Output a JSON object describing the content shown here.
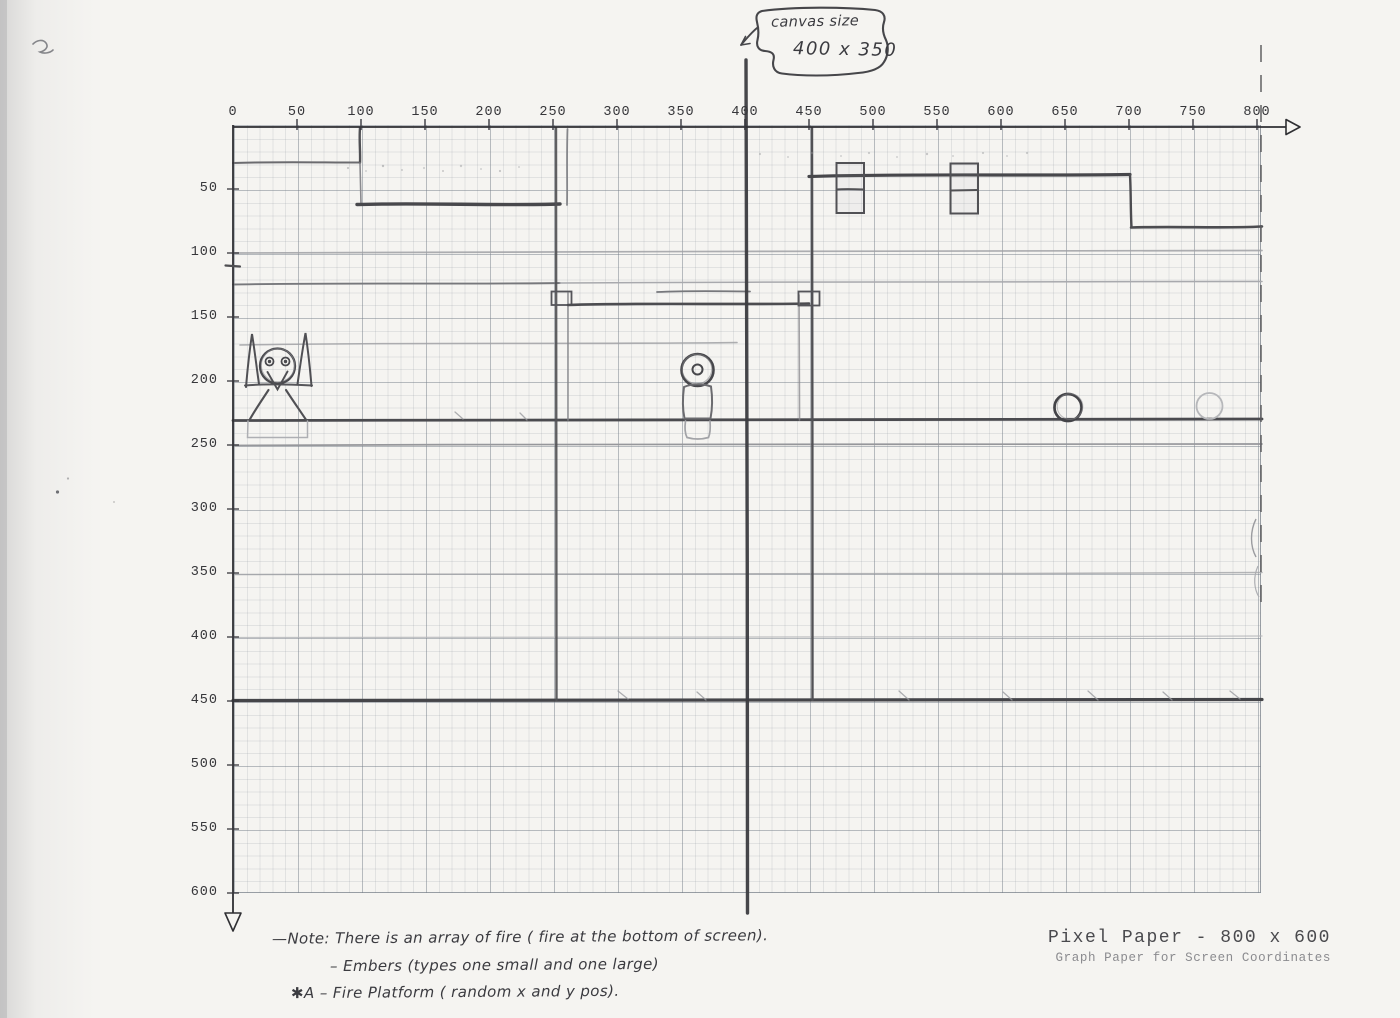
{
  "axes": {
    "x_ticks": [
      0,
      50,
      100,
      150,
      200,
      250,
      300,
      350,
      400,
      450,
      500,
      550,
      600,
      650,
      700,
      750,
      800
    ],
    "y_ticks": [
      50,
      100,
      150,
      200,
      250,
      300,
      350,
      400,
      450,
      500,
      550,
      600
    ]
  },
  "bubble": {
    "line1": "canvas size",
    "line2": "400 x 350"
  },
  "notes": {
    "line1": "—Note: There is an array of fire ( fire at the bottom of screen).",
    "line2": "– Embers (types one small and one large)",
    "line3": "✱A – Fire Platform ( random x and y pos)."
  },
  "footer": {
    "title": "Pixel Paper - 800 x 600",
    "subtitle": "Graph Paper for Screen Coordinates"
  },
  "colors": {
    "paper": "#f5f4f1",
    "pencil_dark": "#47474b",
    "pencil_medium": "#77787c",
    "pencil_faint": "#a3a4a8",
    "grid_line": "#9aa0a8"
  },
  "sketch_elements": [
    {
      "name": "canvas-size-callout",
      "text": "canvas size 400 x 350",
      "points_to_x": 400
    },
    {
      "name": "ledge-line",
      "x": [
        0,
        70
      ],
      "y": 30
    },
    {
      "name": "pit-wall",
      "x": 100,
      "y": [
        0,
        62
      ]
    },
    {
      "name": "pit-floor",
      "x": [
        100,
        255
      ],
      "y": 62
    },
    {
      "name": "column-left",
      "x": 252,
      "y": [
        0,
        450
      ]
    },
    {
      "name": "room-beam",
      "x": [
        262,
        450
      ],
      "y": 140
    },
    {
      "name": "column-right",
      "x": 452,
      "y": [
        0,
        450
      ]
    },
    {
      "name": "high-platform",
      "x": [
        450,
        700
      ],
      "y": 40
    },
    {
      "name": "platform-step",
      "x": [
        700,
        800
      ],
      "y": 80
    },
    {
      "name": "item-box",
      "x": [
        472,
        493
      ],
      "y": [
        30,
        69
      ]
    },
    {
      "name": "item-box",
      "x": [
        561,
        582
      ],
      "y": [
        30,
        69
      ]
    },
    {
      "name": "faint-line",
      "x": [
        0,
        800
      ],
      "y": 100
    },
    {
      "name": "faint-line",
      "x": [
        0,
        800
      ],
      "y": 125
    },
    {
      "name": "ground-mid",
      "x": [
        0,
        800
      ],
      "y": 230
    },
    {
      "name": "faint-line",
      "x": [
        0,
        800
      ],
      "y": 250
    },
    {
      "name": "faint-line",
      "x": [
        0,
        800
      ],
      "y": 350
    },
    {
      "name": "faint-line",
      "x": [
        0,
        800
      ],
      "y": 400
    },
    {
      "name": "ground-main",
      "x": [
        0,
        800
      ],
      "y": 450
    },
    {
      "name": "canvas-boundary",
      "x": 400,
      "y": [
        0,
        600
      ]
    },
    {
      "name": "right-boundary-dashed",
      "x": 800,
      "y": [
        0,
        380
      ]
    },
    {
      "name": "horned-character",
      "x": 35,
      "y": [
        160,
        230
      ]
    },
    {
      "name": "pawn-figure",
      "x": 363,
      "y": [
        180,
        245
      ]
    },
    {
      "name": "ember-circle",
      "x": 652,
      "y": 221
    },
    {
      "name": "ember-circle-faint",
      "x": 763,
      "y": 220
    }
  ]
}
